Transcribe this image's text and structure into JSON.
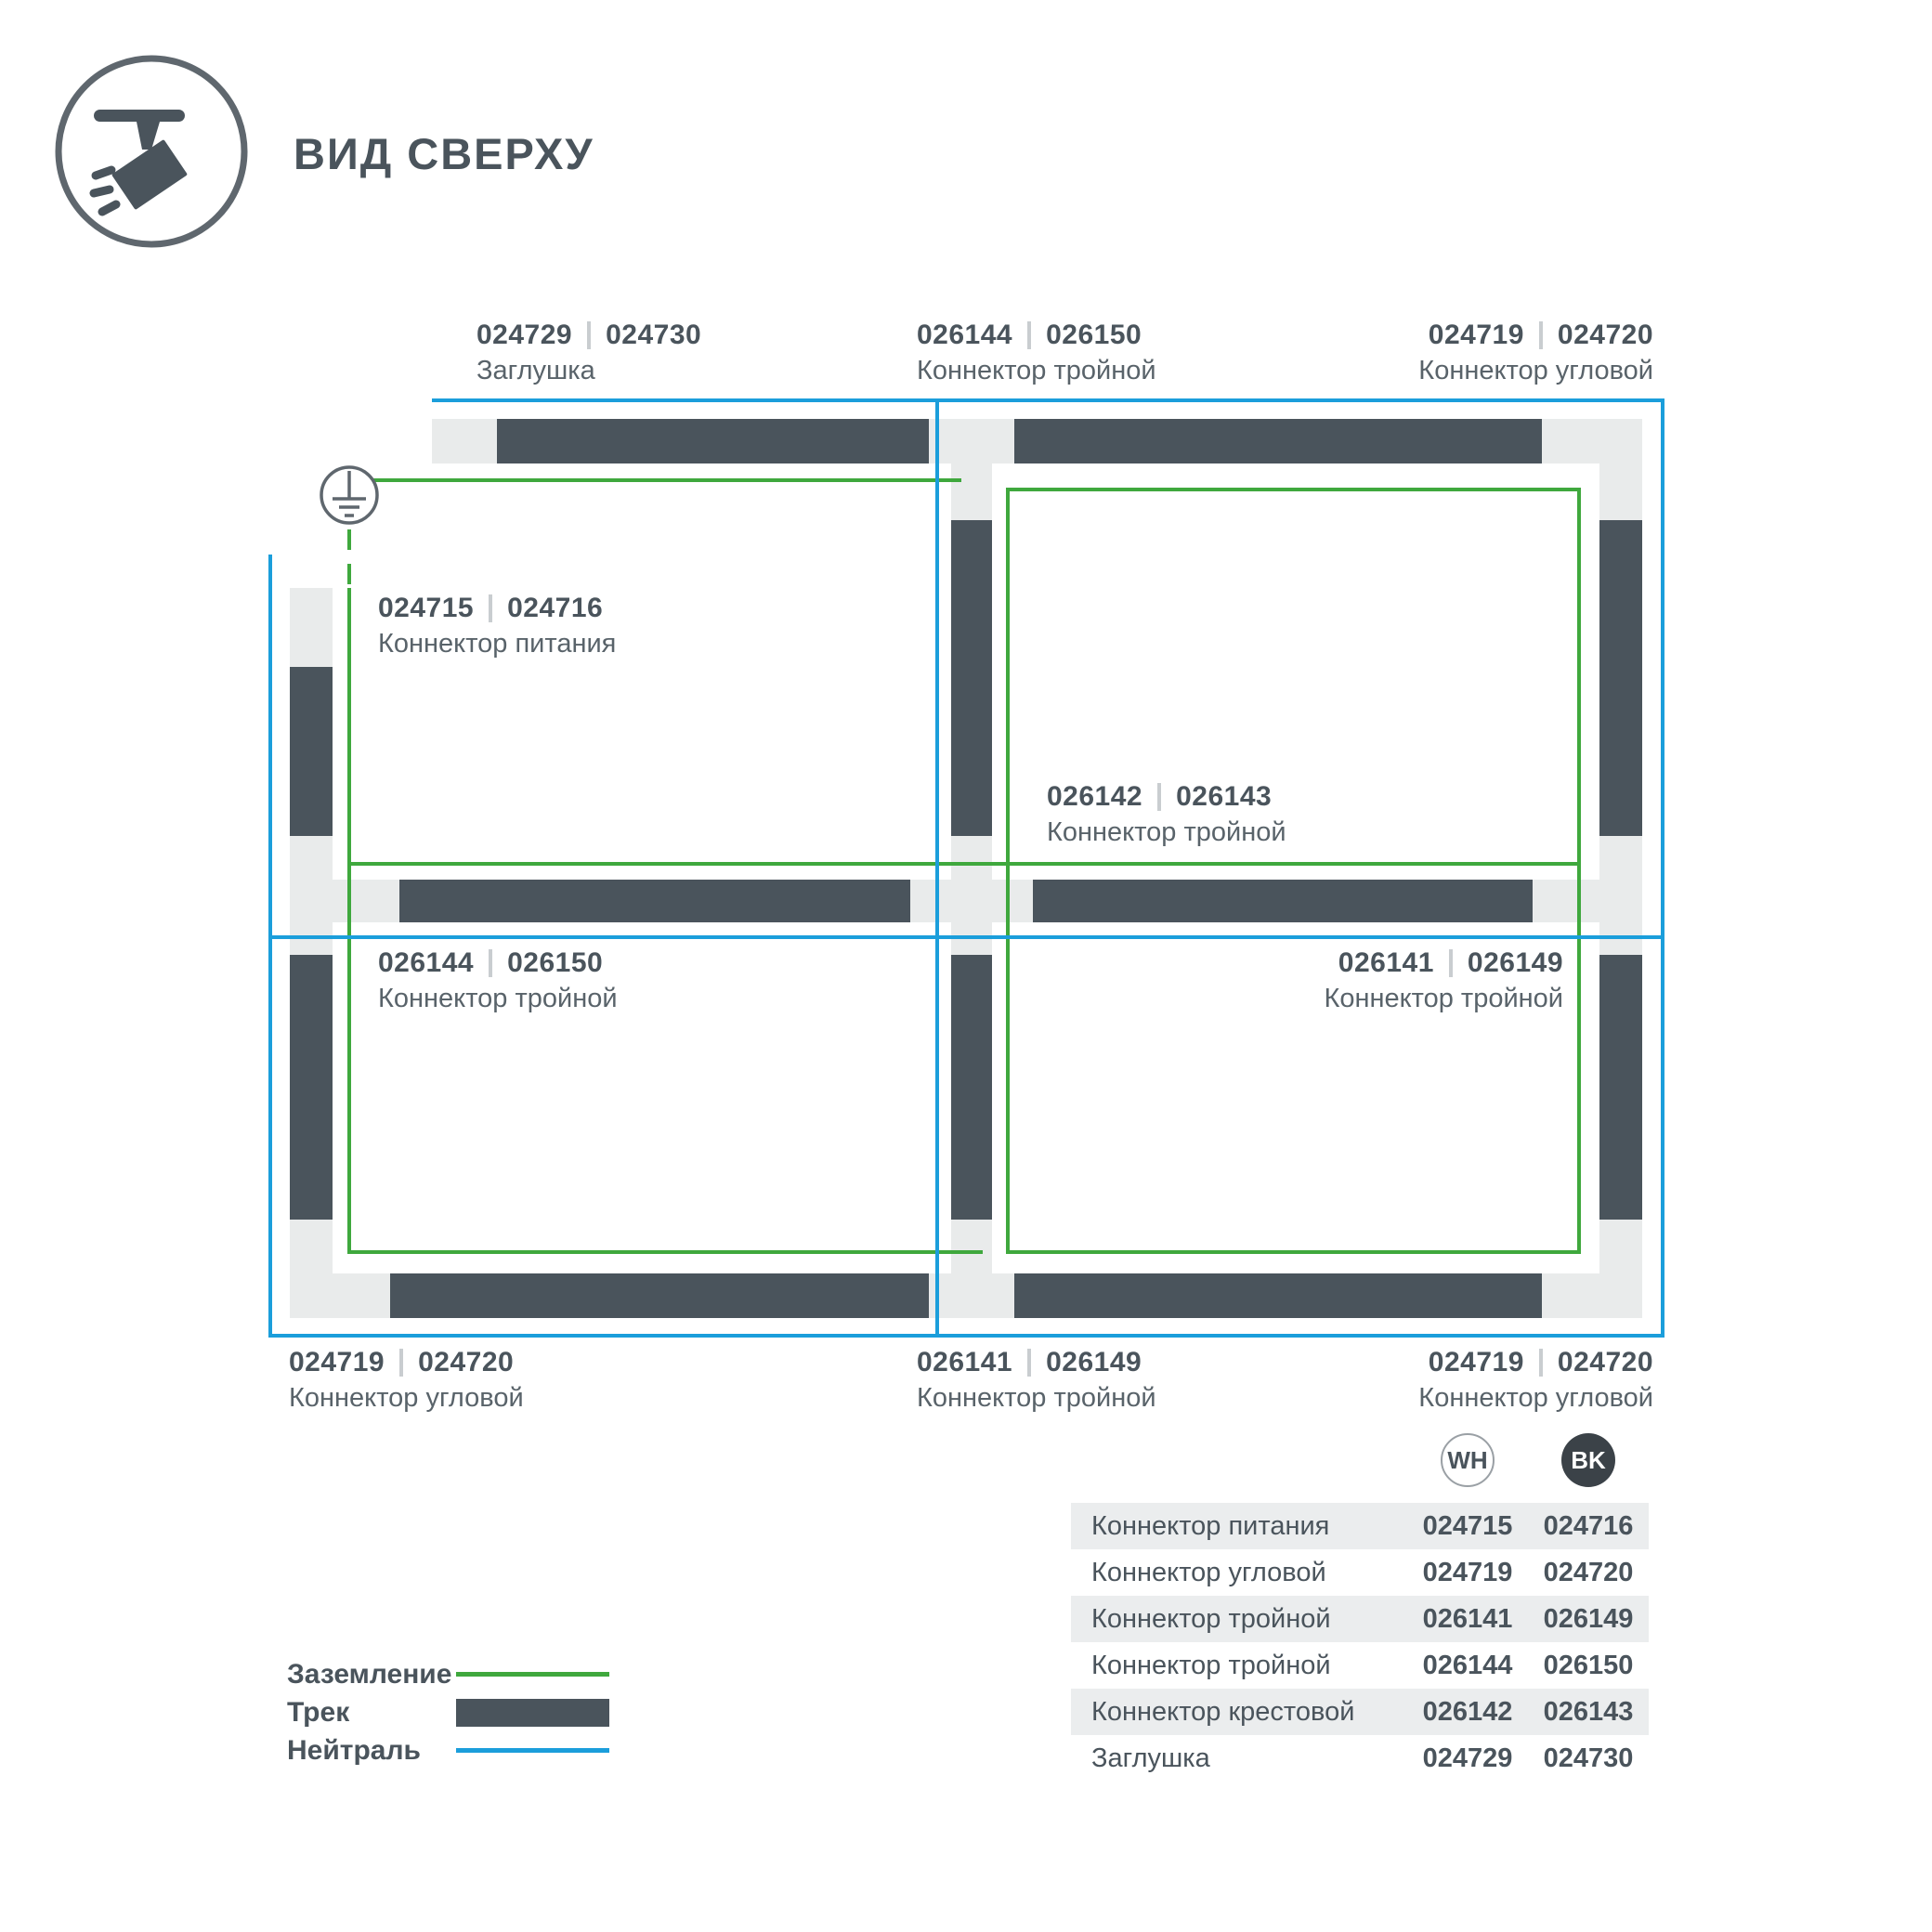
{
  "header": {
    "title": "ВИД СВЕРХУ",
    "icon": "spotlight-track-icon"
  },
  "colors": {
    "track_dark": "#4a545c",
    "track_base": "#e9ebeb",
    "ground_green": "#3fa83d",
    "neutral_blue": "#1b9edb",
    "text_dark": "#4a545c",
    "text_caption": "#59636a",
    "separator": "#c9cdd0",
    "table_row_shade": "#ebedee",
    "bk_fill": "#3b4248"
  },
  "diagram": {
    "ground_icon": "earth-ground-symbol",
    "labels": {
      "top_left": {
        "wh": "024729",
        "bk": "024730",
        "caption": "Заглушка"
      },
      "top_mid": {
        "wh": "026144",
        "bk": "026150",
        "caption": "Коннектор тройной"
      },
      "top_right": {
        "wh": "024719",
        "bk": "024720",
        "caption": "Коннектор угловой"
      },
      "power": {
        "wh": "024715",
        "bk": "024716",
        "caption": "Коннектор питания"
      },
      "center": {
        "wh": "026142",
        "bk": "026143",
        "caption": "Коннектор тройной"
      },
      "mid_left": {
        "wh": "026144",
        "bk": "026150",
        "caption": "Коннектор тройной"
      },
      "mid_right": {
        "wh": "026141",
        "bk": "026149",
        "caption": "Коннектор тройной"
      },
      "bottom_left": {
        "wh": "024719",
        "bk": "024720",
        "caption": "Коннектор угловой"
      },
      "bottom_mid": {
        "wh": "026141",
        "bk": "026149",
        "caption": "Коннектор тройной"
      },
      "bottom_right": {
        "wh": "024719",
        "bk": "024720",
        "caption": "Коннектор угловой"
      }
    }
  },
  "legend": {
    "ground": "Заземление",
    "track": "Трек",
    "neutral": "Нейтраль"
  },
  "table": {
    "columns": {
      "wh": "WH",
      "bk": "BK"
    },
    "rows": [
      {
        "name": "Коннектор питания",
        "wh": "024715",
        "bk": "024716"
      },
      {
        "name": "Коннектор угловой",
        "wh": "024719",
        "bk": "024720"
      },
      {
        "name": "Коннектор тройной",
        "wh": "026141",
        "bk": "026149"
      },
      {
        "name": "Коннектор тройной",
        "wh": "026144",
        "bk": "026150"
      },
      {
        "name": "Коннектор крестовой",
        "wh": "026142",
        "bk": "026143"
      },
      {
        "name": "Заглушка",
        "wh": "024729",
        "bk": "024730"
      }
    ]
  }
}
